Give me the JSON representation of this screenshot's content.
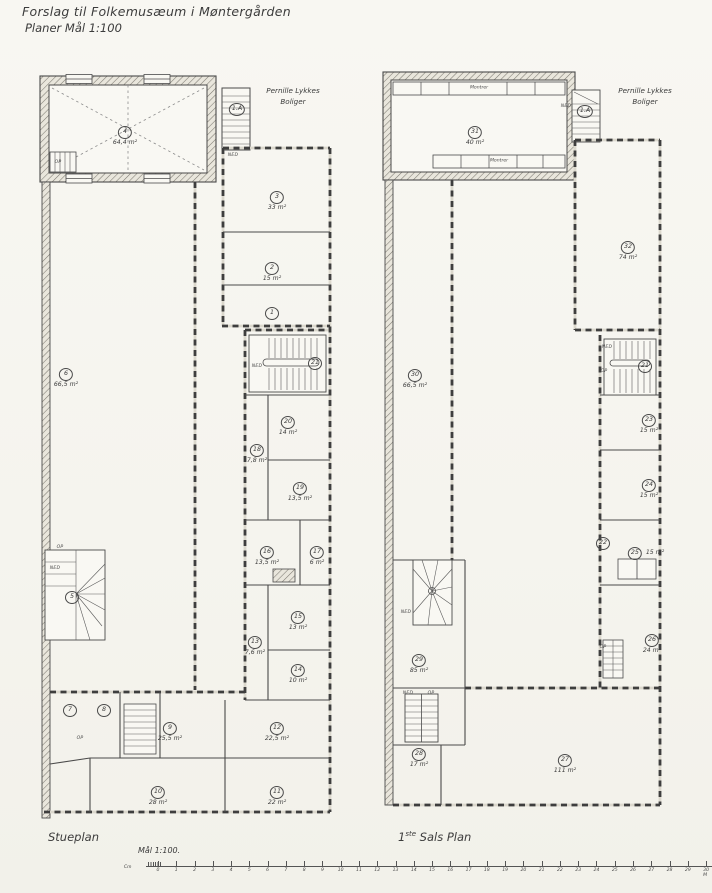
{
  "header": {
    "title_line1": "Forslag til Folkemusæum i Møntergården",
    "title_line2": "Planer   Mål 1:100"
  },
  "neighbor": {
    "line1": "Pernille Lykkes",
    "line2": "Boliger"
  },
  "stair_texts": {
    "ned": "NED",
    "op": "OP"
  },
  "left_plan": {
    "caption": "Stueplan",
    "stair_label": "1.A",
    "rooms": [
      {
        "no": "4",
        "area": "64,4 m²"
      },
      {
        "no": "3",
        "area": "33 m²"
      },
      {
        "no": "2",
        "area": "15 m²"
      },
      {
        "no": "1",
        "area": ""
      },
      {
        "no": "6",
        "area": "66,5 m²"
      },
      {
        "no": "5",
        "area": ""
      },
      {
        "no": "21",
        "area": ""
      },
      {
        "no": "20",
        "area": "14 m²"
      },
      {
        "no": "18",
        "area": "7,8 m²"
      },
      {
        "no": "19",
        "area": "13,5 m²"
      },
      {
        "no": "16",
        "area": "13,5 m²"
      },
      {
        "no": "17",
        "area": "6 m²"
      },
      {
        "no": "15",
        "area": "13 m²"
      },
      {
        "no": "13",
        "area": "7,6 m²"
      },
      {
        "no": "14",
        "area": "10 m²"
      },
      {
        "no": "7",
        "area": ""
      },
      {
        "no": "8",
        "area": ""
      },
      {
        "no": "9",
        "area": "25,5 m²"
      },
      {
        "no": "12",
        "area": "22,5 m²"
      },
      {
        "no": "10",
        "area": "28 m²"
      },
      {
        "no": "11",
        "area": "22 m²"
      }
    ]
  },
  "right_plan": {
    "caption": {
      "num": "1",
      "sup": "ste",
      "rest": " Sals Plan"
    },
    "stair_label": "1.A",
    "montrer": "Montrer",
    "rooms": [
      {
        "no": "31",
        "area": "40 m²"
      },
      {
        "no": "32",
        "area": "74 m²"
      },
      {
        "no": "30",
        "area": "66,5 m²"
      },
      {
        "no": "21",
        "area": ""
      },
      {
        "no": "23",
        "area": "15 m²"
      },
      {
        "no": "24",
        "area": "15 m²"
      },
      {
        "no": "22",
        "area": ""
      },
      {
        "no": "25",
        "area": "15 m²"
      },
      {
        "no": "26",
        "area": "24 m²"
      },
      {
        "no": "29",
        "area": "85 m²"
      },
      {
        "no": "28",
        "area": "17 m²"
      },
      {
        "no": "27",
        "area": "111 m²"
      }
    ]
  },
  "scale_bar": {
    "label": "Mål 1:100.",
    "unit": "Cm",
    "ticks": [
      "0",
      "1",
      "2",
      "3",
      "4",
      "5",
      "6",
      "7",
      "8",
      "9",
      "10",
      "11",
      "12",
      "13",
      "14",
      "15",
      "16",
      "17",
      "18",
      "19",
      "20",
      "21",
      "22",
      "23",
      "24",
      "25",
      "26",
      "27",
      "28",
      "29",
      "30 M"
    ]
  }
}
